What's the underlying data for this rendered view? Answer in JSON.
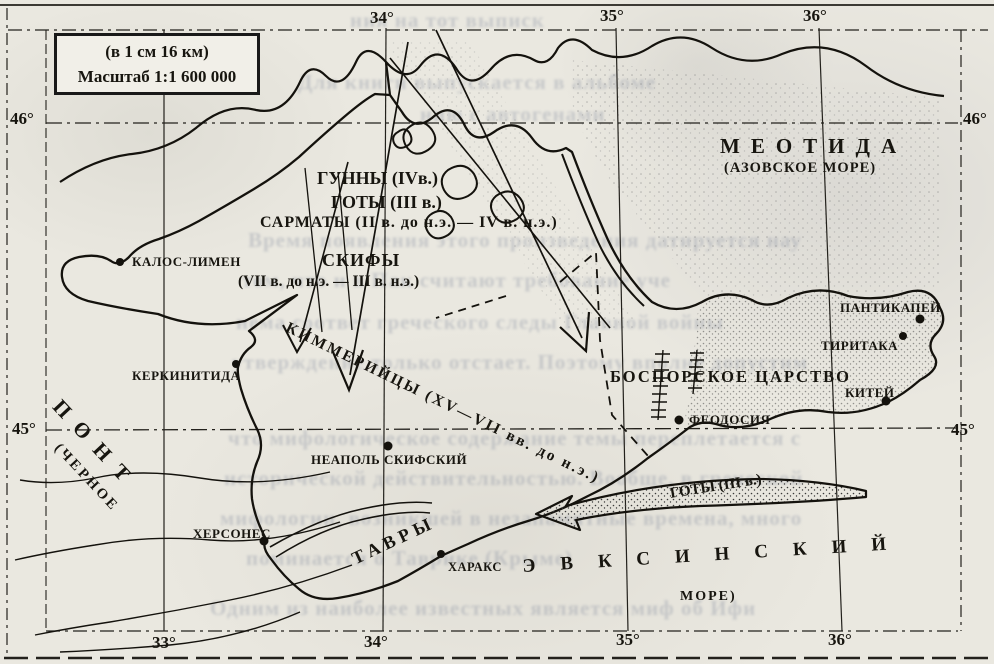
{
  "scale_box": {
    "line1": "(в 1 см 16 км)",
    "line2": "Масштаб 1:1 600 000"
  },
  "graticule": {
    "top": [
      "34°",
      "35°",
      "36°"
    ],
    "bottom": [
      "33°",
      "34°",
      "35°",
      "36°"
    ],
    "left": [
      "46°",
      "45°"
    ],
    "right": [
      "46°",
      "45°"
    ]
  },
  "seas": {
    "azov_title": "МЕОТИДА",
    "azov_sub": "(АЗОВСКОЕ МОРЕ)",
    "pont_title": "ПОНТ",
    "pont_sub": "(ЧЕРНОЕ",
    "euxine_title": "ЭВКСИНСКИЙ",
    "euxine_sub": "МОРЕ)"
  },
  "peoples": {
    "huns": "ГУННЫ (IVв.)",
    "goths": "ГОТЫ (III в.)",
    "sarmatians": "САРМАТЫ (II в. до н.э. — IV в. н.э.)",
    "scythians": "СКИФЫ",
    "scythians_dates": "(VII в. до н.э. — III в. н.э.)",
    "cimmerians": "КИММЕРИЙЦЫ (XV—VII вв. до н.э.)",
    "tauri": "ТАВРЫ",
    "goths_arrow": "ГОТЫ (III в.)"
  },
  "regions": {
    "bosporan": "БОСПОРСКОЕ ЦАРСТВО"
  },
  "cities": [
    {
      "name": "КАЛОС-ЛИМЕН"
    },
    {
      "name": "КЕРКИНИТИДА"
    },
    {
      "name": "НЕАПОЛЬ СКИФСКИЙ"
    },
    {
      "name": "ХЕРСОНЕС"
    },
    {
      "name": "ХАРАКС"
    },
    {
      "name": "ФЕОДОСИЯ"
    },
    {
      "name": "ПАНТИКАПЕЙ"
    },
    {
      "name": "ТИРИТАКА"
    },
    {
      "name": "КИТЕЙ"
    }
  ],
  "colors": {
    "ink": "#17150f",
    "paper": "#eae8e0",
    "ghost": "#6e7890"
  },
  "bleedthrough": {
    "lines": [
      "ния на тот выписк",
      "Для книги выпускается в альбоме",
      "нию с автогенами",
      "Время появления этого произведения датируется нау",
      "том, что и в Пак считают требование уче",
      "нема соответ греческого следы Главной войны",
      "утверждение только отстает. Поэтому вполне допустим",
      "что мифологическое содержание темы переплетается с",
      "исторической действительностью. Вообще, в греческой",
      "мифологии, возникшей в незапамятные времена, много",
      "поминается о Таврике (Крыме)",
      "Одним из наиболее известных является миф об Ифи"
    ]
  }
}
